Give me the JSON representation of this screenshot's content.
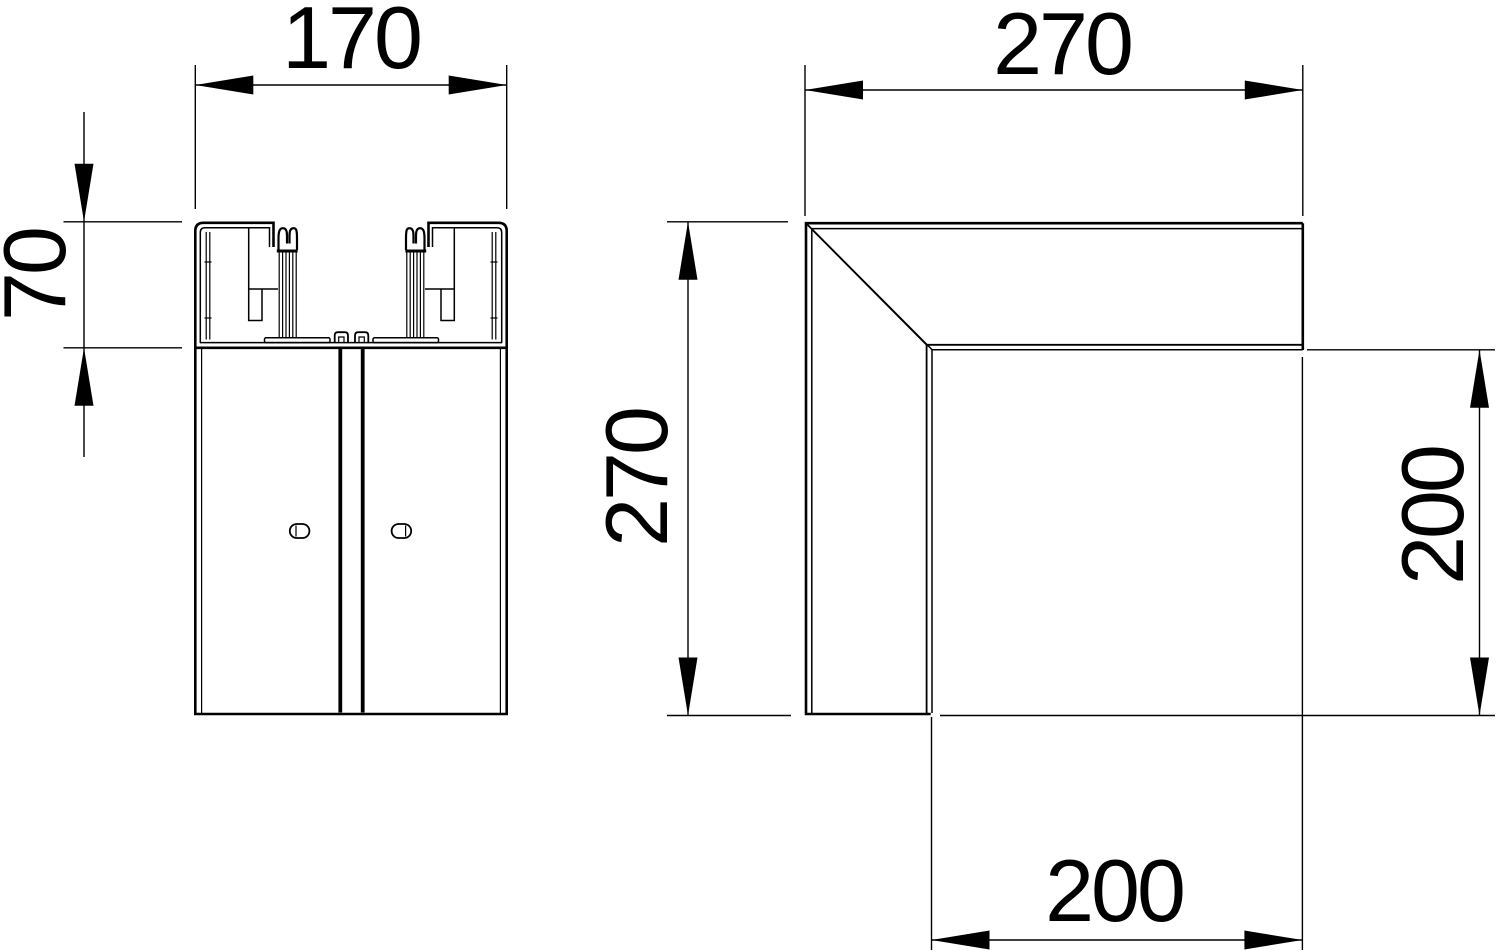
{
  "drawing": {
    "background_color": "#ffffff",
    "line_color": "#000000",
    "views": [
      {
        "id": "profile-cross-section",
        "description": "trunking profile cross-section, left view",
        "dimensions": [
          {
            "label": "170",
            "orientation": "horizontal",
            "position": "top"
          },
          {
            "label": "70",
            "orientation": "vertical",
            "position": "left"
          }
        ]
      },
      {
        "id": "flat-angle-outline",
        "description": "90 degree flat angle outline, right view",
        "dimensions": [
          {
            "label": "270",
            "orientation": "horizontal",
            "position": "top"
          },
          {
            "label": "270",
            "orientation": "vertical",
            "position": "left"
          },
          {
            "label": "200",
            "orientation": "vertical",
            "position": "right"
          },
          {
            "label": "200",
            "orientation": "horizontal",
            "position": "bottom"
          }
        ]
      }
    ]
  }
}
